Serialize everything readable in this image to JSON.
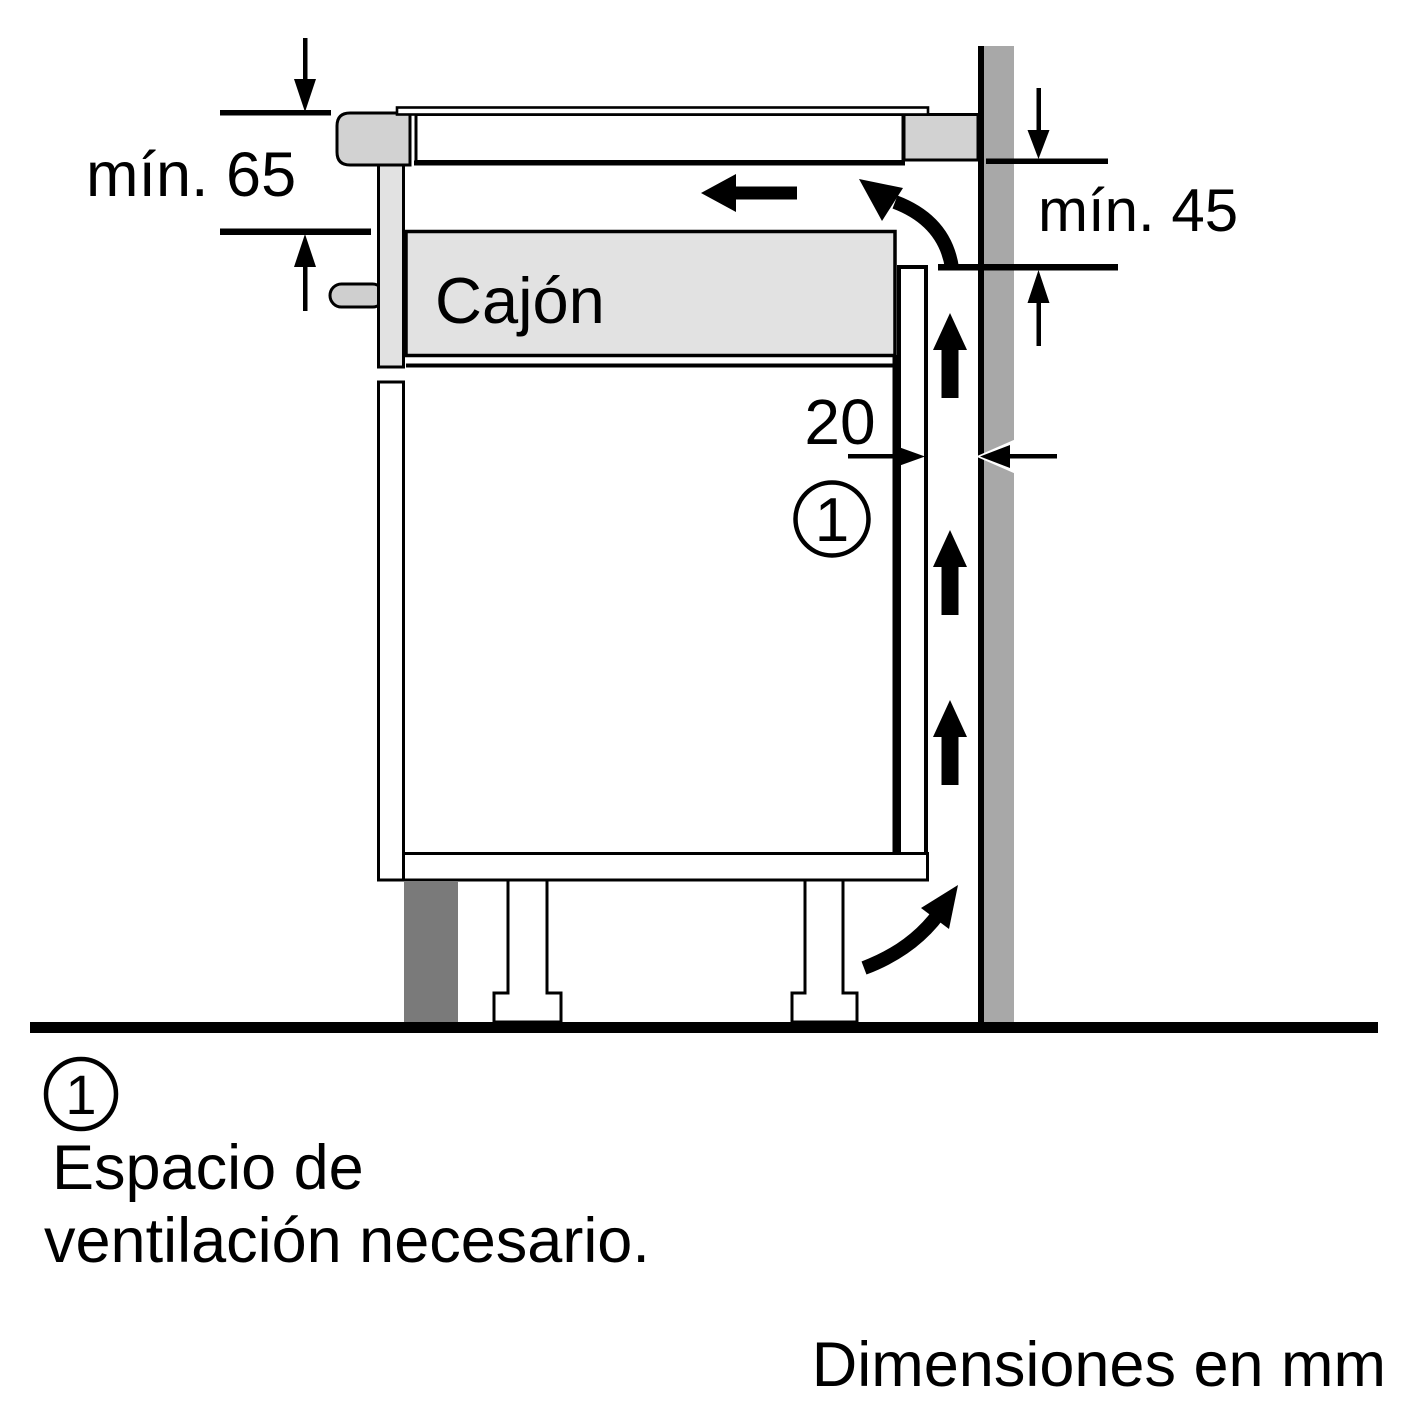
{
  "diagram": {
    "dimension_labels": {
      "top_clearance": "mín. 65",
      "side_clearance": "mín. 45",
      "vent_gap": "20"
    },
    "drawer_label": "Cajón",
    "callout": {
      "number": "1"
    },
    "legend": {
      "number": "1",
      "line1": "Espacio de",
      "line2": "ventilación necesario."
    },
    "footer": {
      "units_note": "Dimensiones en mm"
    },
    "colors": {
      "outline": "#000000",
      "background": "#ffffff",
      "wall_gray": "#a8a8a8",
      "plinth_gray": "#7a7a7a",
      "hob_frame_gray": "#d2d2d2",
      "drawer_gray": "#e2e2e2",
      "handle_gray": "#cfcfcf"
    }
  }
}
